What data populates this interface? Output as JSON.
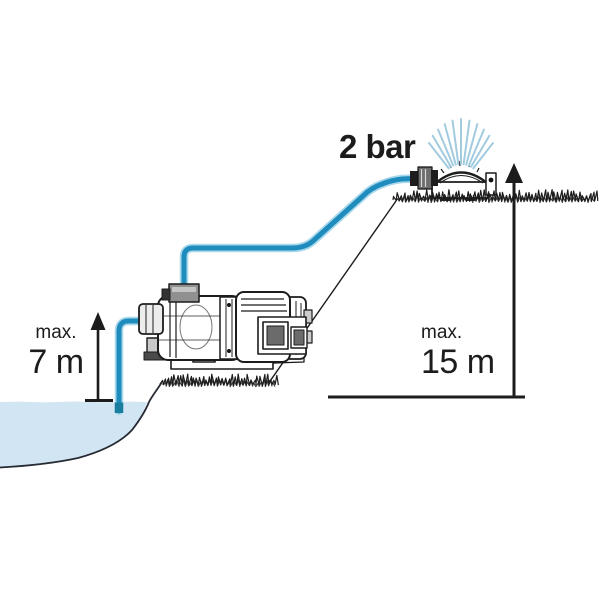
{
  "diagram": {
    "pressure_label": "2 bar",
    "suction_height": {
      "prefix": "max.",
      "value": "7 m"
    },
    "delivery_height": {
      "prefix": "max.",
      "value": "15 m"
    }
  },
  "colors": {
    "hose_blue": "#1f8cbd",
    "hose_highlight": "#a8d8ec",
    "underwater_pipe": "#1a7f9e",
    "water_fill": "#d2e5f3",
    "spray_blue": "#a2cbdf",
    "ink": "#1c1c1c"
  },
  "illustrations": {
    "pump": "garden-jet-pump",
    "sprinkler": "oscillating-sprinkler",
    "water_source": "pond",
    "ground": "grass-lines"
  }
}
